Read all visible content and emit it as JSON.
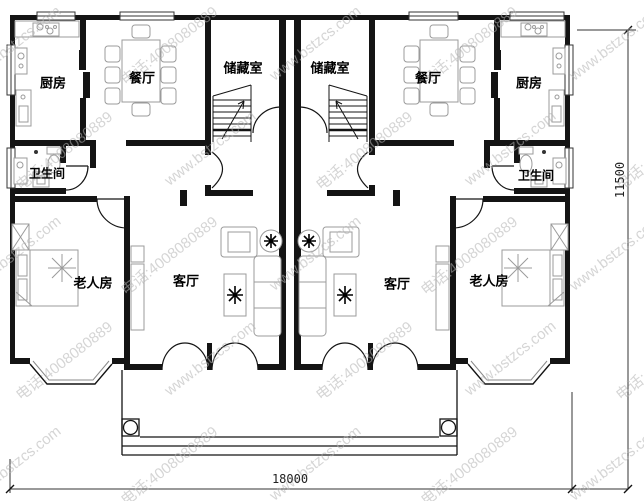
{
  "rooms": {
    "kitchen_left": "厨房",
    "dining_left": "餐厅",
    "storage_left": "储藏室",
    "storage_right": "储藏室",
    "dining_right": "餐厅",
    "kitchen_right": "厨房",
    "bath_left": "卫生间",
    "bath_right": "卫生间",
    "elder_left": "老人房",
    "living_left": "客厅",
    "living_right": "客厅",
    "elder_right": "老人房"
  },
  "dimensions": {
    "width": "18000",
    "height": "11500"
  },
  "watermark": {
    "site": "www.bstzcs.com",
    "phone": "电话:4008080889"
  },
  "colors": {
    "wall": "#141414",
    "furniture": "#9b9b9b",
    "watermark": "#b3b3b3"
  }
}
